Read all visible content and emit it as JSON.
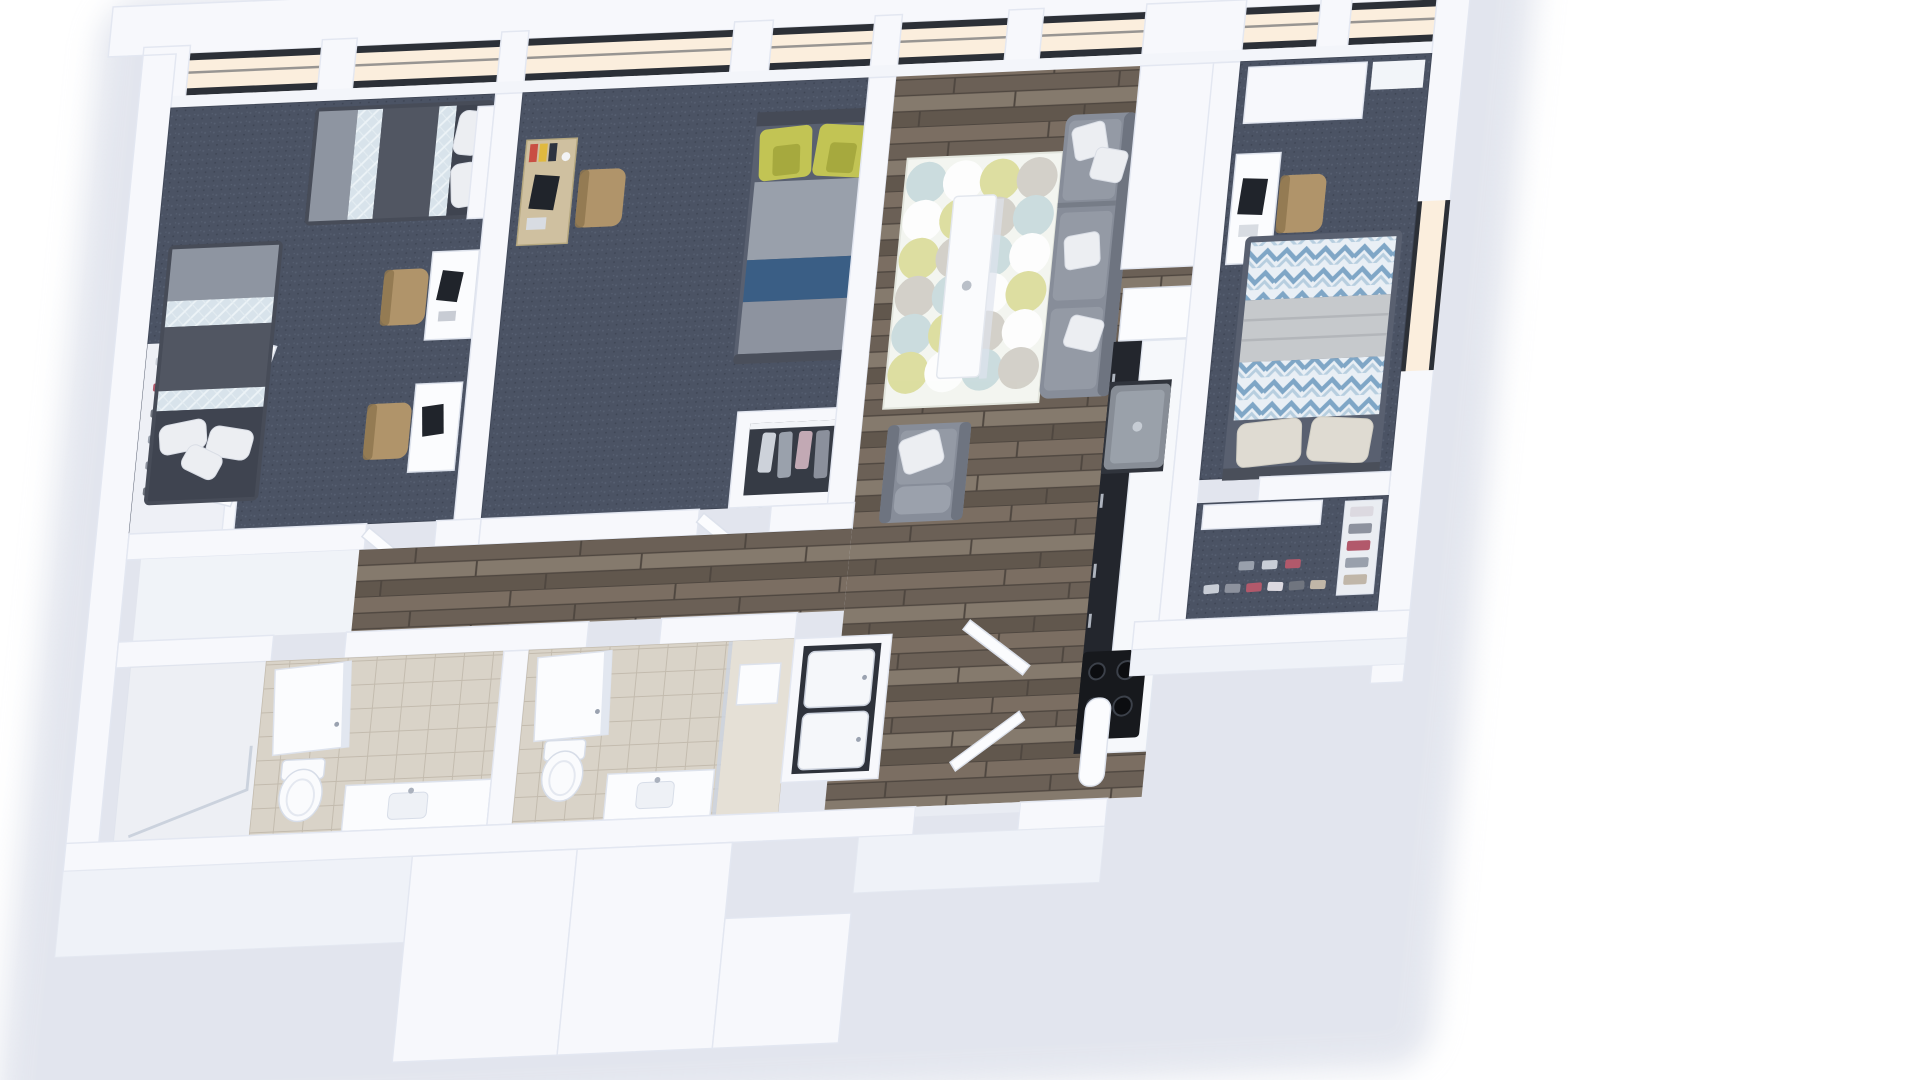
{
  "meta": {
    "kind": "3d-rendered-floor-plan",
    "view": "top-down isometric"
  },
  "colors": {
    "page_bg": "#ffffff",
    "drop_shadow": "#c7cdde",
    "wall": "#f7f8fc",
    "wall_stroke": "#e3e7f1",
    "wall_face": "#eff2f8",
    "window_glass": "#fbeedd",
    "window_frame": "#2c3037",
    "window_mullion": "#474c54",
    "sill": "#f3f5fa",
    "carpet_base": "#4b5364",
    "carpet_dot_light": "#576072",
    "carpet_dot_dark": "#3e4554",
    "wood_plank_1": "#7b6e62",
    "wood_plank_2": "#6b6056",
    "wood_plank_3": "#857a6d",
    "wood_plank_4": "#61574d",
    "wood_gap": "#4f4740",
    "tile_base": "#d9d3c8",
    "tile_line": "#c3bbae",
    "shower_floor": "#edeff4",
    "shower_niche": "#e5e0d6",
    "bed_frame": "#474c58",
    "bed_gray": "#8e95a1",
    "bed_mid": "#515662",
    "bed_head": "#3f4450",
    "quilt_base": "#d8e3eb",
    "quilt_line": "#ecf3f7",
    "bed2_frame": "#596070",
    "mattress_gray": "#99a0ab",
    "navy_runner": "#3a5e85",
    "foot_gray": "#8d939f",
    "green_pillow": "#c2c454",
    "green_pillow_dark": "#a6a93e",
    "chevron_bg": "#e9eff5",
    "chevron_main": "#7fa6c6",
    "chevron_soft": "#b7cedf",
    "blanket_gray": "#c6c9cc",
    "pillow_beige": "#dfdbd2",
    "pillow_white": "#eceef2",
    "sofa": "#878d99",
    "sofa_dark": "#6e7480",
    "sofa_cushion": "#949aa5",
    "rug_base": "#f3f5f0",
    "rug_blue": "#c2d7d9",
    "rug_yellow": "#d8d98f",
    "rug_gray": "#ccc9c0",
    "table_white": "#fafbfd",
    "desk_wood": "#cfc0a0",
    "chair_wood": "#b0946a",
    "laptop": "#20242b",
    "cabinet_dark": "#23262d",
    "counter": "#f6f8fb",
    "fridge_body": "#878d96",
    "fridge_door": "#9aa1aa",
    "fridge_niche": "#30343c",
    "cooktop": "#17191d",
    "burner": "#0c0d10",
    "burner_rim": "#3c414a",
    "laundry_niche": "#2e323b",
    "appliance": "#f5f7fa",
    "closet_niche": "#363b45",
    "porcelain": "#fafbfd"
  },
  "rooms": [
    {
      "id": "bedroom-1",
      "floor": "carpet",
      "furniture": [
        "twin-bed",
        "twin-bed",
        "desk",
        "chair",
        "desk",
        "chair",
        "closet",
        "shoe-rack",
        "sliding-doors"
      ]
    },
    {
      "id": "bedroom-2",
      "floor": "carpet",
      "furniture": [
        "bed-green-pillows",
        "desk",
        "chair",
        "closet-with-clothes"
      ]
    },
    {
      "id": "living-room",
      "floor": "hardwood",
      "furniture": [
        "area-rug",
        "coffee-table",
        "sectional-sofa",
        "armchair"
      ]
    },
    {
      "id": "kitchen",
      "floor": "hardwood",
      "furniture": [
        "pantry-cabinet",
        "counter-peninsula",
        "refrigerator",
        "counter-run",
        "cooktop"
      ]
    },
    {
      "id": "bedroom-3",
      "floor": "carpet",
      "furniture": [
        "bed-chevron-duvet",
        "desk",
        "chair",
        "wardrobe"
      ]
    },
    {
      "id": "walk-in-closet",
      "floor": "carpet",
      "furniture": [
        "shelf",
        "shoe-rows",
        "shoe-rack"
      ]
    },
    {
      "id": "bathroom-1",
      "floor": "tile",
      "furniture": [
        "shower",
        "mirror-cabinet",
        "toilet",
        "vanity-sink"
      ]
    },
    {
      "id": "bathroom-2",
      "floor": "tile",
      "furniture": [
        "mirror-cabinet",
        "toilet",
        "shower-niche",
        "vanity-sink"
      ]
    },
    {
      "id": "laundry-closet",
      "floor": "hardwood",
      "furniture": [
        "stacked-washer",
        "stacked-dryer"
      ]
    },
    {
      "id": "entry-hall",
      "floor": "hardwood",
      "furniture": [
        "door-leaf",
        "door-leaf",
        "column"
      ]
    }
  ],
  "windows": [
    "north-wall-glazing",
    "east-wall-window"
  ],
  "walls": [
    "exterior-shell",
    "interior-partitions",
    "lower-vestibule-blocks"
  ]
}
